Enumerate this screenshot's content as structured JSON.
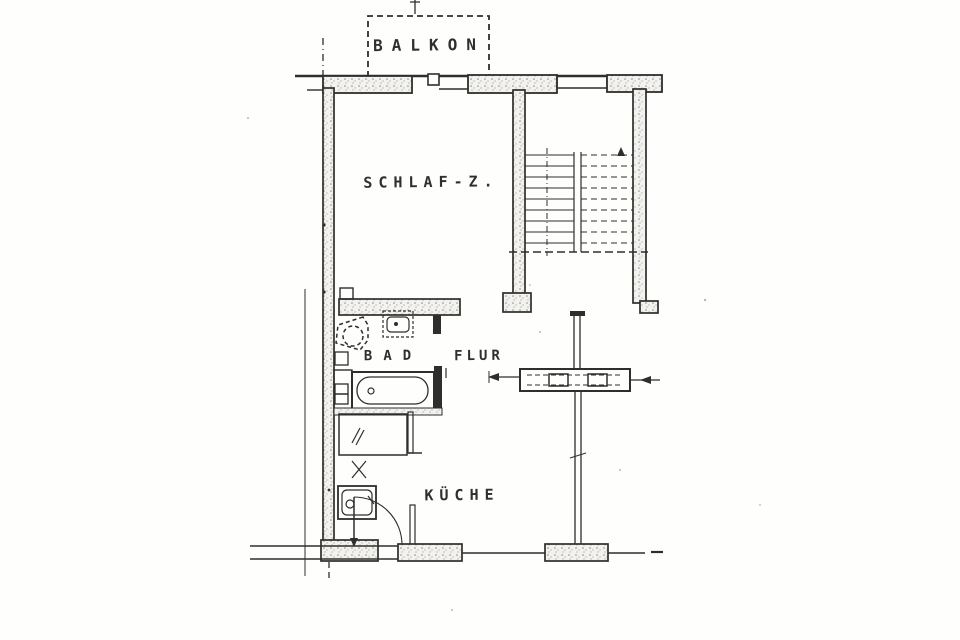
{
  "document": {
    "kind": "scanned apartment floor plan",
    "palette": {
      "paper": "#fefefd",
      "ink": "#2e2e2c",
      "speckle": "#8d8d85"
    }
  },
  "rooms": {
    "balkon": {
      "label": "BALKON"
    },
    "schlafzimmer": {
      "label": "SCHLAF-Z."
    },
    "bad": {
      "label": "BAD"
    },
    "flur": {
      "label": "FLUR"
    },
    "kueche": {
      "label": "KÜCHE"
    }
  },
  "features": [
    "balcony-outline",
    "exterior-walls",
    "staircase",
    "stair-direction-line",
    "bathtub",
    "toilet",
    "washbasin",
    "kitchen-sink",
    "kitchen-cabinet",
    "door-swing",
    "chimney-flue",
    "section-marks"
  ]
}
